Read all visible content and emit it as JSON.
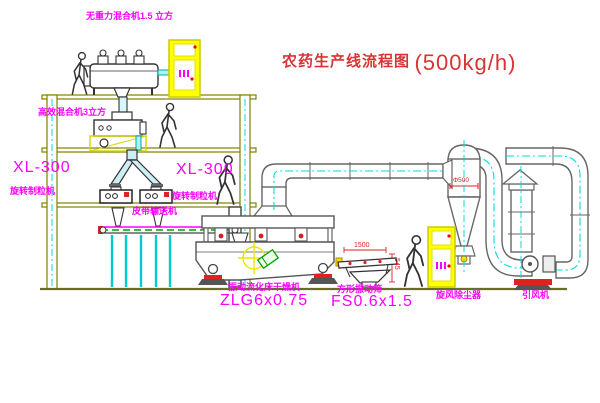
{
  "title": {
    "cn": "农药生产线流程图",
    "capacity": "(500kg/h)"
  },
  "labels": {
    "top_mixer": "无重力混合机1.5 立方",
    "mid_mixer": "高效混合机3立方",
    "xl_left_model": "XL-300",
    "xl_left_name": "旋转制粒机",
    "xl_center_model": "XL-300",
    "xl_center_name": "旋转制粒机",
    "belt_conveyor": "皮带输送机",
    "dryer_name": "振动流化床干燥机",
    "dryer_model": "ZLG6x0.75",
    "sieve_name": "方形振动筛",
    "sieve_model": "FS0.6x1.5",
    "cyclone": "旋风除尘器",
    "fan": "引风机"
  },
  "dims": {
    "sieve_length": "1500",
    "sieve_height": "545",
    "cyclone_dia": "Φ500"
  },
  "colors": {
    "label_magenta": "#ff00ff",
    "title_red": "#d83434",
    "structure_olive": "#808000",
    "centerline_cyan": "#00dcdc",
    "cabinet_yellow": "#ffff00",
    "accent_red": "#dd2222",
    "accent_green": "#00a000",
    "machine_dark": "#3c3c3c"
  }
}
